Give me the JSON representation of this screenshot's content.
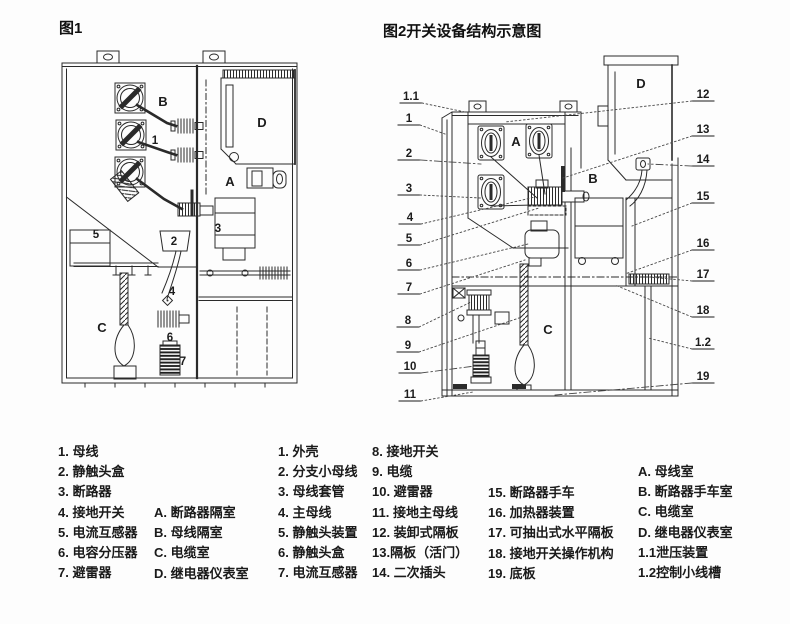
{
  "page": {
    "background": "#fdfdfd",
    "ink": "#2a2a2a"
  },
  "figure1": {
    "title": "图1",
    "labels": [
      {
        "label": "B",
        "x": 123,
        "y": 61,
        "big": true
      },
      {
        "label": "1",
        "x": 115,
        "y": 99
      },
      {
        "label": "D",
        "x": 222,
        "y": 82,
        "big": true
      },
      {
        "label": "A",
        "x": 190,
        "y": 141,
        "big": true
      },
      {
        "label": "3",
        "x": 178,
        "y": 187
      },
      {
        "label": "2",
        "x": 134,
        "y": 200
      },
      {
        "label": "5",
        "x": 56,
        "y": 193
      },
      {
        "label": "4",
        "x": 132,
        "y": 250
      },
      {
        "label": "C",
        "x": 62,
        "y": 287,
        "big": true
      },
      {
        "label": "6",
        "x": 130,
        "y": 296
      },
      {
        "label": "7",
        "x": 143,
        "y": 320
      }
    ]
  },
  "figure2": {
    "title": "图2开关设备结构示意图",
    "callouts_left": [
      {
        "label": "1.1",
        "x": 16,
        "y": 52,
        "tx": 70,
        "ty": 64
      },
      {
        "label": "1",
        "x": 14,
        "y": 74,
        "tx": 50,
        "ty": 86
      },
      {
        "label": "2",
        "x": 14,
        "y": 109,
        "tx": 86,
        "ty": 116,
        "dd": true
      },
      {
        "label": "3",
        "x": 14,
        "y": 144,
        "tx": 86,
        "ty": 150
      },
      {
        "label": "4",
        "x": 15,
        "y": 173,
        "tx": 140,
        "ty": 149
      },
      {
        "label": "5",
        "x": 14,
        "y": 194,
        "tx": 144,
        "ty": 160
      },
      {
        "label": "6",
        "x": 14,
        "y": 219,
        "tx": 133,
        "ty": 196
      },
      {
        "label": "7",
        "x": 14,
        "y": 243,
        "tx": 130,
        "ty": 212
      },
      {
        "label": "8",
        "x": 13,
        "y": 276,
        "tx": 76,
        "ty": 254
      },
      {
        "label": "9",
        "x": 13,
        "y": 301,
        "tx": 124,
        "ty": 270
      },
      {
        "label": "10",
        "x": 15,
        "y": 322,
        "tx": 80,
        "ty": 318,
        "dd": true
      },
      {
        "label": "11",
        "x": 15,
        "y": 350,
        "tx": 78,
        "ty": 344
      }
    ],
    "callouts_right": [
      {
        "label": "12",
        "x": 308,
        "y": 50,
        "tx": 110,
        "ty": 74
      },
      {
        "label": "13",
        "x": 308,
        "y": 85,
        "tx": 168,
        "ty": 130
      },
      {
        "label": "14",
        "x": 308,
        "y": 115,
        "tx": 253,
        "ty": 116,
        "dd": true
      },
      {
        "label": "15",
        "x": 308,
        "y": 152,
        "tx": 237,
        "ty": 178
      },
      {
        "label": "16",
        "x": 308,
        "y": 199,
        "tx": 230,
        "ty": 226
      },
      {
        "label": "17",
        "x": 308,
        "y": 230,
        "tx": 254,
        "ty": 229
      },
      {
        "label": "18",
        "x": 308,
        "y": 266,
        "tx": 220,
        "ty": 237
      },
      {
        "label": "1.2",
        "x": 308,
        "y": 298,
        "tx": 253,
        "ty": 290
      },
      {
        "label": "19",
        "x": 308,
        "y": 332,
        "tx": 160,
        "ty": 347,
        "dd": true
      }
    ],
    "letters": [
      {
        "label": "A",
        "x": 121,
        "y": 98,
        "big": true
      },
      {
        "label": "B",
        "x": 198,
        "y": 135,
        "big": true
      },
      {
        "label": "C",
        "x": 153,
        "y": 286,
        "big": true
      },
      {
        "label": "D",
        "x": 246,
        "y": 40,
        "big": true
      }
    ]
  },
  "legend": {
    "fig1_items": [
      "1. 母线",
      "2. 静触头盒",
      "3. 断路器",
      "4. 接地开关",
      "5. 电流互感器",
      "6. 电容分压器",
      "7. 避雷器"
    ],
    "fig1_rooms": [
      "A. 断路器隔室",
      "B. 母线隔室",
      "C. 电缆室",
      "D. 继电器仪表室"
    ],
    "fig2_items_a": [
      "1. 外壳",
      "2. 分支小母线",
      "3. 母线套管",
      "4. 主母线",
      "5. 静触头装置",
      "6. 静触头盒",
      "7. 电流互感器"
    ],
    "fig2_items_b": [
      "8. 接地开关",
      "9. 电缆",
      "10. 避雷器",
      "11. 接地主母线",
      "12. 装卸式隔板",
      "13.隔板（活门）",
      "14. 二次插头"
    ],
    "fig2_items_c": [
      "15. 断路器手车",
      "16. 加热器装置",
      "17. 可抽出式水平隔板",
      "18. 接地开关操作机构",
      "19. 底板"
    ],
    "fig2_rooms": [
      "A. 母线室",
      "B. 断路器手车室",
      "C. 电缆室",
      "D. 继电器仪表室",
      "1.1泄压装置",
      "1.2控制小线槽"
    ]
  }
}
